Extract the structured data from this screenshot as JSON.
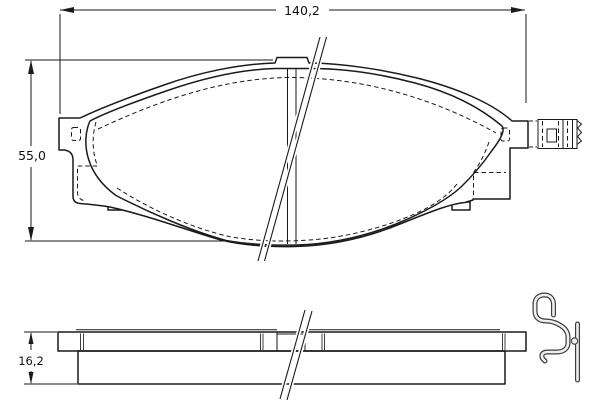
{
  "drawing": {
    "type": "technical-drawing",
    "subject": "brake-pad",
    "dimensions": {
      "width_label": "140,2",
      "height_label": "55,0",
      "thickness_label": "16,2"
    },
    "colors": {
      "friction_material": "#f8b4bc",
      "outline": "#1a1a1a",
      "background": "#ffffff",
      "hardware_outline": "#3c3c3c",
      "hardware_fill": "#f0f0f0"
    },
    "icons": [
      {
        "name": "wear-indicator-connector-icon"
      },
      {
        "name": "retaining-clip-icon"
      }
    ]
  }
}
